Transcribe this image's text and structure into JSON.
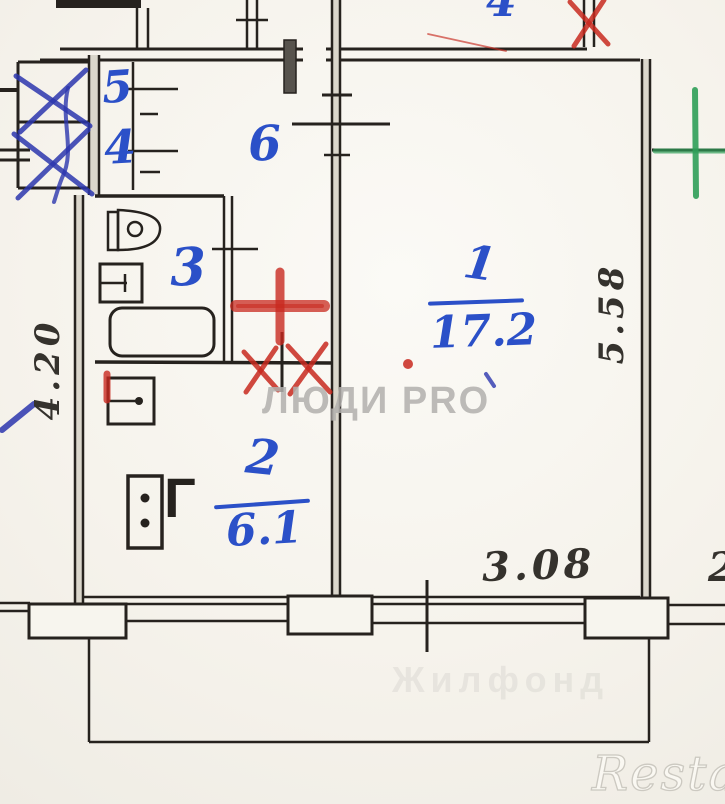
{
  "plan": {
    "type": "apartment-floorplan-scan",
    "rooms": {
      "room1": {
        "number": "1",
        "area": "17.2"
      },
      "room2": {
        "number": "2",
        "area": "6.1"
      },
      "room3": {
        "number": "3"
      },
      "room4": {
        "number": "4"
      },
      "room5": {
        "number": "5"
      },
      "room6": {
        "number": "6"
      },
      "room_top_partial": {
        "number": "4"
      }
    },
    "dimensions": {
      "left_vertical": "4.20",
      "right_vertical": "5.58",
      "bottom": "3.08",
      "bottom_right_partial": "2"
    },
    "fixtures": {
      "stove_gas_label": "Г",
      "icons": [
        "toilet-icon",
        "washbasin-icon",
        "bathtub-icon",
        "kitchen-sink-icon",
        "stove-icon"
      ]
    },
    "watermarks": {
      "center": "ЛЮДИ PRO",
      "balcony_faint": "Жилфонд",
      "logo": "Restate"
    },
    "colors": {
      "ink": "#26221e",
      "wall_fill": "#dad6cb",
      "blue_handwriting": "#2b50c8",
      "blue_pen": "#2c36ae",
      "red_mark": "#c8291f",
      "green_mark": "#2f9e58",
      "pencil": "#35322d",
      "watermark_gray": "#b2b0ad",
      "paper": "#f6f3ec"
    }
  }
}
